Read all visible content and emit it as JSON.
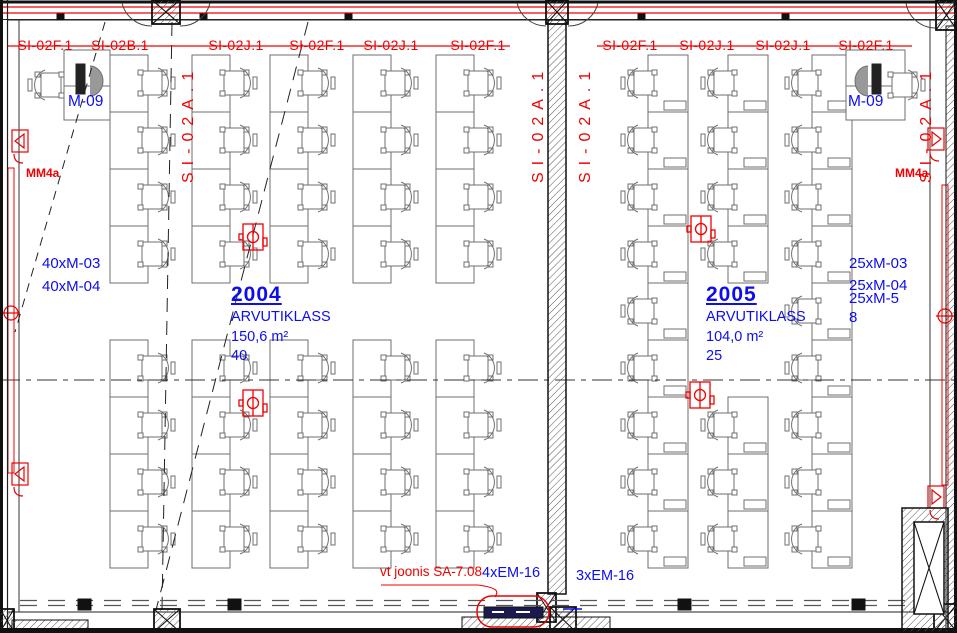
{
  "drawing": {
    "si_line_labels_room1": [
      "SI-02F.1",
      "SI-02B.1",
      "SI-02J.1",
      "SI-02F.1",
      "SI-02J.1",
      "SI-02F.1"
    ],
    "si_line_labels_room2": [
      "SI-02F.1",
      "SI-02J.1",
      "SI-02J.1",
      "SI-02F.1"
    ],
    "si_vertical_label": "SI-02A.1",
    "rooms": [
      {
        "number": "2004",
        "name": "ARVUTIKLASS",
        "area": "150,6 m²",
        "capacity": "40",
        "furniture_codes": [
          "40xM-03",
          "40xM-04"
        ],
        "workstation": "M-09"
      },
      {
        "number": "2005",
        "name": "ARVUTIKLASS",
        "area": "104,0 m²",
        "capacity": "25",
        "furniture_codes": [
          "25xM-03",
          "25xM-04",
          "25xM-5",
          "8"
        ],
        "workstation": "M-09"
      }
    ],
    "wall_labels": {
      "left": "MM4a",
      "right": "MM4a"
    },
    "notes": {
      "reference": "vt joonis SA-7.08",
      "em_left": "4xEM-16",
      "em_right": "3xEM-16"
    },
    "colors": {
      "annotation_red": "#f00000",
      "annotation_blue": "#0d0dee",
      "wall": "#111111",
      "furniture": "#6f6f6f"
    }
  }
}
